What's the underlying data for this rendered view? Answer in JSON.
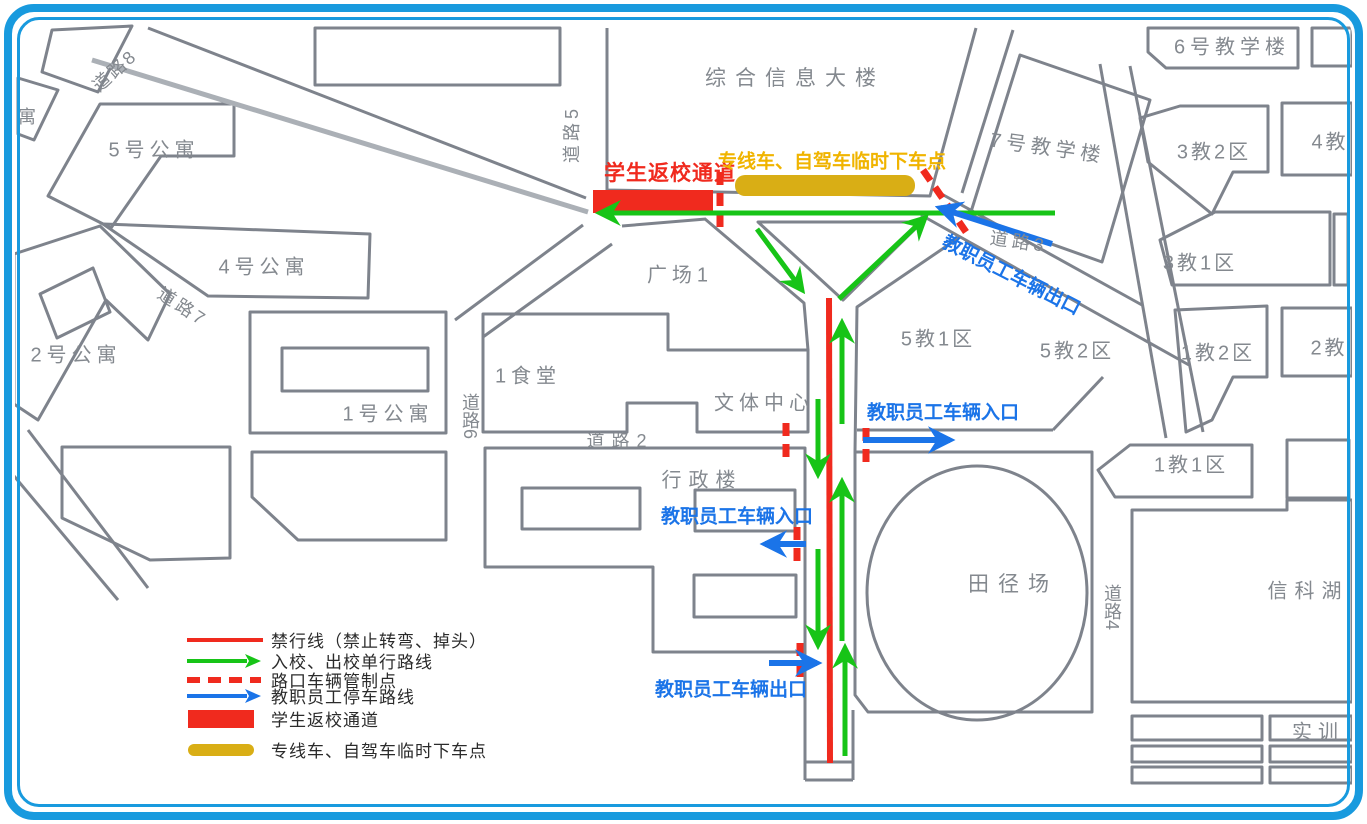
{
  "colors": {
    "frame_blue": "#189ade",
    "building_gray": "#7e838c",
    "label_gray": "#84898f",
    "no_entry_red": "#f02a1e",
    "route_green": "#17c417",
    "staff_blue": "#1b74e8",
    "dropoff_gold": "#d9ae15",
    "dropoff_text_gold": "#f0b400"
  },
  "map": {
    "building_labels": [
      {
        "text": "综合信息大楼"
      },
      {
        "text": "6号教学楼"
      },
      {
        "text": "7号教学楼"
      },
      {
        "text": "3教2区"
      },
      {
        "text": "4教"
      },
      {
        "text": "3教1区"
      },
      {
        "text": "1教2区"
      },
      {
        "text": "2教"
      },
      {
        "text": "5教1区"
      },
      {
        "text": "5教2区"
      },
      {
        "text": "1教1区"
      },
      {
        "text": "5号公寓"
      },
      {
        "text": "4号公寓"
      },
      {
        "text": "2号公寓"
      },
      {
        "text": "1号公寓"
      },
      {
        "text": "广场1"
      },
      {
        "text": "1食堂"
      },
      {
        "text": "文体中心"
      },
      {
        "text": "行政楼"
      },
      {
        "text": "田径场"
      },
      {
        "text": "信科湖"
      },
      {
        "text": "实训"
      },
      {
        "text": "寓"
      }
    ],
    "road_labels": [
      {
        "text": "道路8"
      },
      {
        "text": "道路5"
      },
      {
        "text": "道路7"
      },
      {
        "text": "道路6"
      },
      {
        "text": "道路2"
      },
      {
        "text": "道路3"
      },
      {
        "text": "道路4"
      }
    ],
    "annotations": {
      "student_channel": "学生返校通道",
      "dropoff_point": "专线车、自驾车临时下车点",
      "staff_exit_ne": "教职员工车辆出口",
      "staff_entry_e": "教职员工车辆入口",
      "staff_entry_w": "教职员工车辆入口",
      "staff_exit_s": "教职员工车辆出口"
    }
  },
  "legend": {
    "items": [
      {
        "swatch": "red-line",
        "label": "禁行线（禁止转弯、掉头）"
      },
      {
        "swatch": "green-arrow",
        "label": "入校、出校单行路线"
      },
      {
        "swatch": "red-dashed",
        "label": "路口车辆管制点"
      },
      {
        "swatch": "blue-arrow",
        "label": "教职员工停车路线"
      },
      {
        "swatch": "red-rect",
        "label": "学生返校通道"
      },
      {
        "swatch": "gold-pill",
        "label": "专线车、自驾车临时下车点"
      }
    ]
  }
}
